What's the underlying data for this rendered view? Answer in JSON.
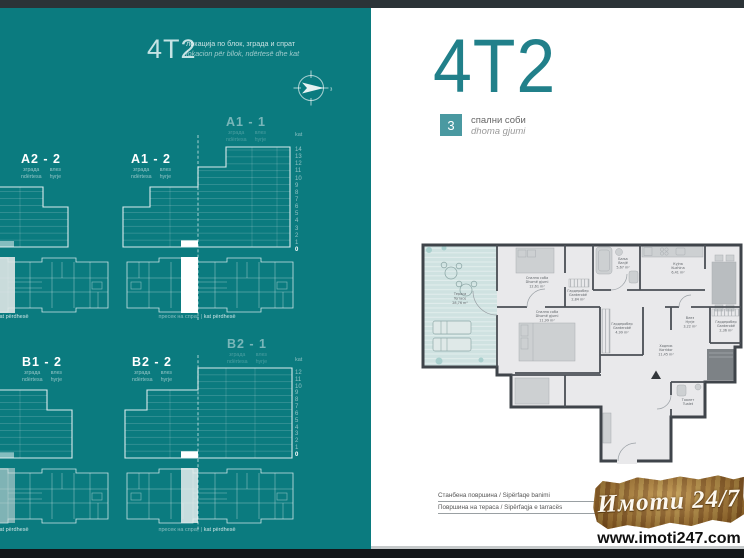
{
  "left_page": {
    "header": {
      "code": "4T2",
      "subtitle_mk": "локација по блок, зграда и спрат",
      "subtitle_sq": "lokacion për bllok, ndërtesë dhe kat"
    },
    "compass": {
      "direction_label": "з"
    },
    "legend": {
      "building_mk": "зграда",
      "building_sq": "ndërtesa",
      "entry_mk": "влез",
      "entry_sq": "hyrje",
      "floor_axis_label": "kat"
    },
    "upper_blocks": {
      "labels": [
        "A2 - 2",
        "A1 - 2",
        "A1 - 1"
      ],
      "floors": [
        "14",
        "13",
        "12",
        "11",
        "10",
        "9",
        "8",
        "7",
        "6",
        "5",
        "4",
        "3",
        "2",
        "1",
        "0"
      ]
    },
    "lower_blocks": {
      "labels": [
        "B1 - 2",
        "B2 - 2",
        "B2 - 1"
      ],
      "floors": [
        "12",
        "11",
        "10",
        "9",
        "8",
        "7",
        "6",
        "5",
        "4",
        "3",
        "2",
        "1",
        "0"
      ]
    },
    "caption": {
      "mk": "пресек на спрат",
      "sep": "|",
      "sq": "kat përdhesë"
    }
  },
  "right_page": {
    "title": "4T2",
    "bedrooms": {
      "count": "3",
      "label_mk": "спални соби",
      "label_sq": "dhoma gjumi"
    },
    "floorplan_rooms": [
      {
        "mk": "Тераса",
        "sq": "Terrace",
        "area": "28,76 m²"
      },
      {
        "mk": "Спална соба",
        "sq": "Dhomë gjumi",
        "area": "12,61 m²"
      },
      {
        "mk": "Гардеробер",
        "sq": "Garderobë",
        "area": "2,84 m²"
      },
      {
        "mk": "Бања",
        "sq": "Banjë",
        "area": "5,67 m²"
      },
      {
        "mk": "Кујна",
        "sq": "Kuzhina",
        "area": "6,41 m²"
      },
      {
        "mk": "Спална соба",
        "sq": "Dhomë gjumi",
        "area": "11,99 m²"
      },
      {
        "mk": "Влез",
        "sq": "Hyrje",
        "area": "3,22 m²"
      },
      {
        "mk": "Гардеробер",
        "sq": "Garderobë",
        "area": "2,36 m²"
      },
      {
        "mk": "Гардеробер",
        "sq": "Garderobë",
        "area": "4,99 m²"
      },
      {
        "mk": "Ходник",
        "sq": "Korridor",
        "area": "11,45 m²"
      },
      {
        "mk": "Тоалет",
        "sq": "Tualet",
        "area": ""
      }
    ],
    "specs": [
      {
        "label": "Станбена површина / Sipërfaqe banimi"
      },
      {
        "label": "Површина на тераса / Sipërfaqja e tarracës"
      }
    ],
    "watermark": {
      "brand": "Имоти 24/7",
      "url": "www.imoti247.com"
    }
  },
  "colors": {
    "teal_page": "#0b7b7f",
    "title_teal": "#21808a",
    "badge_teal": "#4a99a1",
    "dark_bar": "#2b3337"
  }
}
